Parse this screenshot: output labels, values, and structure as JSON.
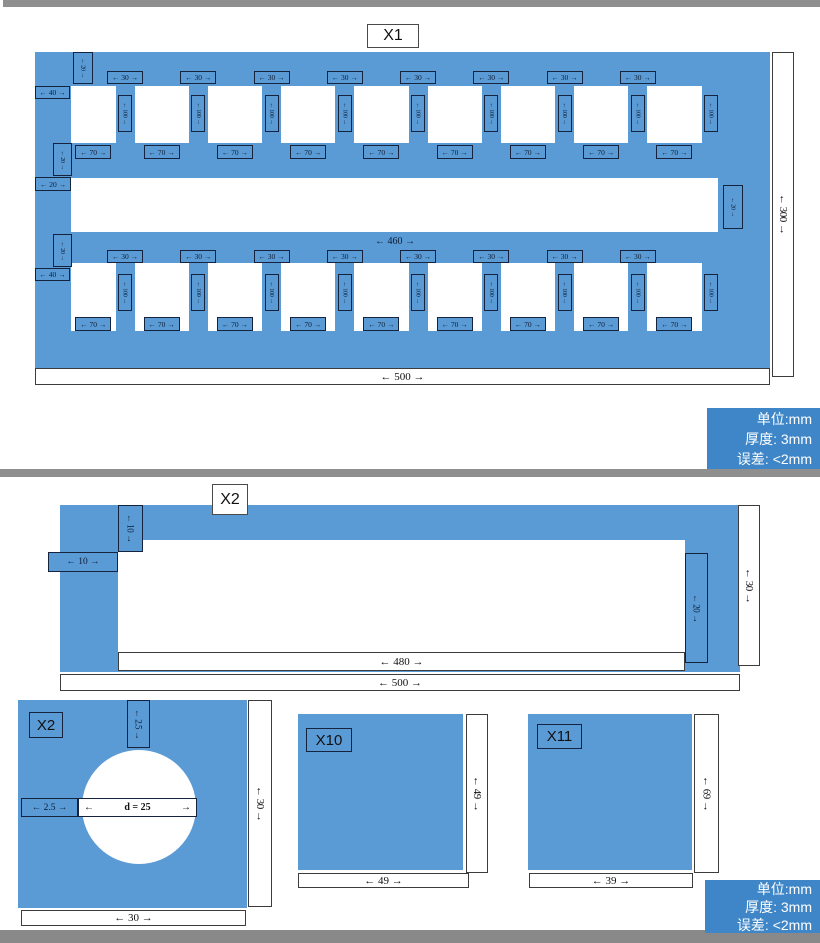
{
  "colors": {
    "part_blue": "#5b9bd5",
    "info_blue": "#3e86c7",
    "bar_gray": "#8f8f8f"
  },
  "info_box": {
    "line1": "单位:mm",
    "line2": "厚度: 3mm",
    "line3": "误差: <2mm"
  },
  "section1": {
    "title": "X1",
    "labels": {
      "w500": "← 500 →",
      "h300": "← 300 →",
      "w460": "← 460 →",
      "w40": "← 40 →",
      "w30": "← 30 →",
      "w70": "← 70 →",
      "w20": "← 20 →",
      "h100": "← 100 →"
    },
    "geometry": {
      "teeth": 9,
      "labeled_teeth": 8,
      "gaps": 9,
      "comb_rows": 2
    }
  },
  "section2": {
    "title": "X2",
    "labels": {
      "d10": "← 10 →",
      "d20": "← 20 →",
      "d30": "← 30 →",
      "d480": "← 480 →",
      "d500": "← 500 →"
    }
  },
  "section3": {
    "part1": {
      "title": "X2",
      "labels": {
        "d2_5": "← 2.5 →",
        "arrow_l": "←",
        "d_text": "d = 25",
        "arrow_r": "→",
        "d30": "← 30 →"
      }
    },
    "part2": {
      "title": "X10",
      "labels": {
        "d49": "← 49 →"
      }
    },
    "part3": {
      "title": "X11",
      "labels": {
        "d69": "← 69 →",
        "d39": "← 39 →"
      }
    }
  }
}
